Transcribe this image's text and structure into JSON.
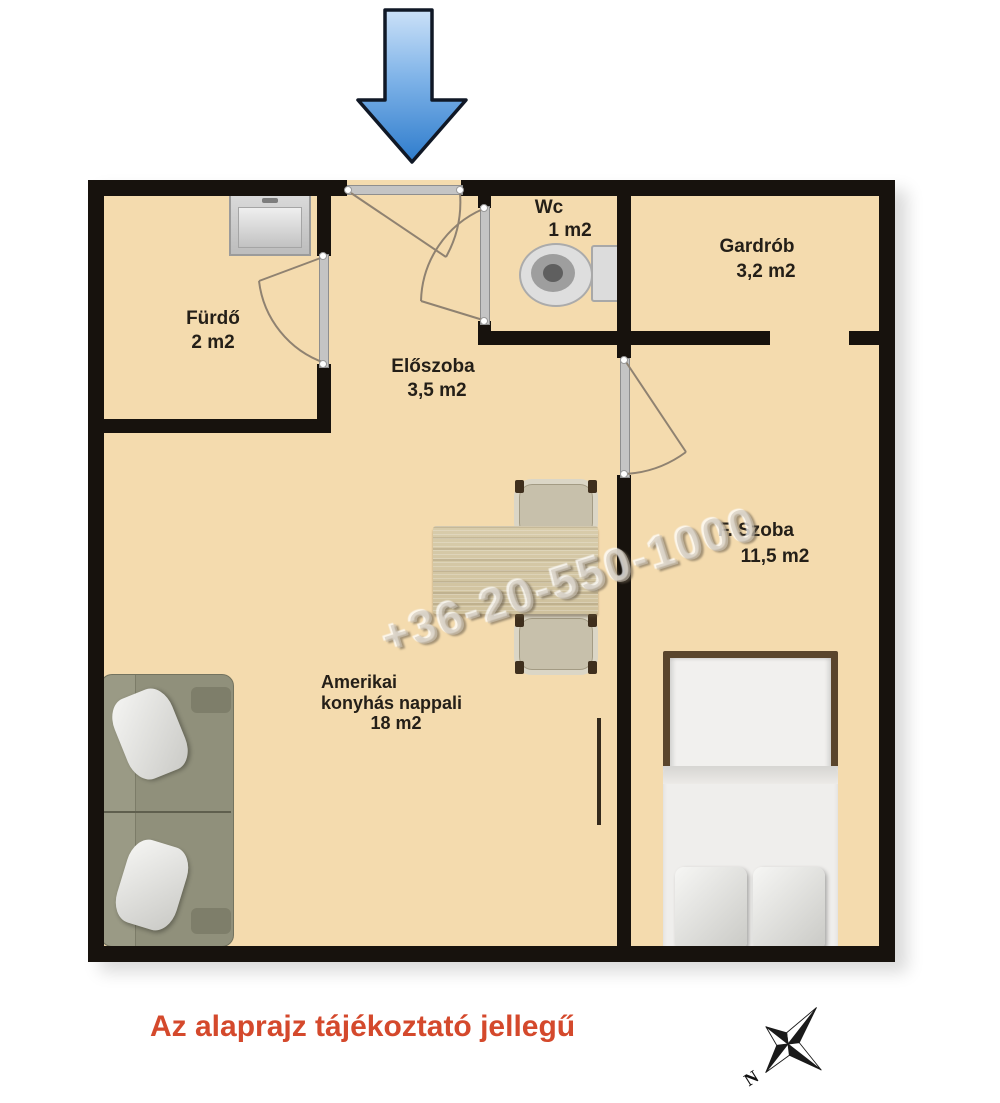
{
  "rooms": {
    "furdo": {
      "name": "Fürdő",
      "area": "2 m2"
    },
    "wc": {
      "name": "Wc",
      "area": "1 m2"
    },
    "gardrob": {
      "name": "Gardrób",
      "area": "3,2 m2"
    },
    "eloszoba": {
      "name": "Előszoba",
      "area": "3,5 m2"
    },
    "fszoba": {
      "name": "F. Szoba",
      "area": "11,5 m2"
    },
    "nappali": {
      "name_line1": "Amerikai",
      "name_line2": "konyhás nappali",
      "area": "18 m2"
    }
  },
  "watermark": {
    "text": "+36-20-550-1000"
  },
  "disclaimer": {
    "text": "Az alaprajz tájékoztató jellegű"
  },
  "compass": {
    "north_label": "N"
  },
  "colors": {
    "floor": "#f4dbae",
    "wall": "#17120d",
    "arrow_blue": "#3279cf",
    "disclaimer_red": "#d4492c"
  }
}
